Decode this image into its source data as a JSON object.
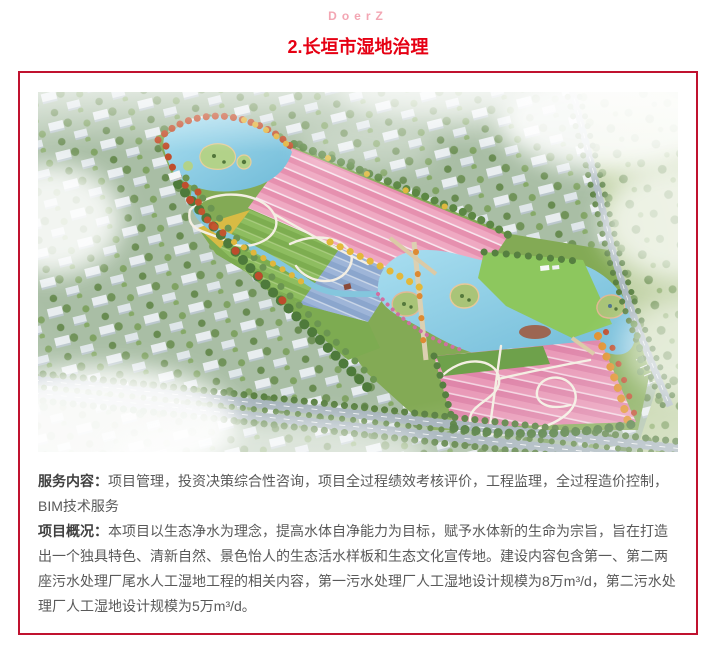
{
  "header": {
    "brand": "DoerZ",
    "title": "2.长垣市湿地治理"
  },
  "colors": {
    "accent_red": "#e60013",
    "border_red": "#c0122f",
    "brand_pink": "#f3a6b3",
    "body_text": "#595959",
    "label_text": "#404040"
  },
  "content": {
    "service_label": "服务内容：",
    "service_text": "项目管理，投资决策综合性咨询，项目全过程绩效考核评价，工程监理，全过程造价控制，BIM技术服务",
    "overview_label": "项目概况：",
    "overview_text": "本项目以生态净水为理念，提高水体自净能力为目标，赋予水体新的生命为宗旨，旨在打造出一个独具特色、清新自然、景色怡人的生态活水样板和生态文化宣传地。建设内容包含第一、第二两座污水处理厂尾水人工湿地工程的相关内容，第一污水处理厂人工湿地设计规模为8万m³/d，第二污水处理厂人工湿地设计规模为5万m³/d。"
  }
}
